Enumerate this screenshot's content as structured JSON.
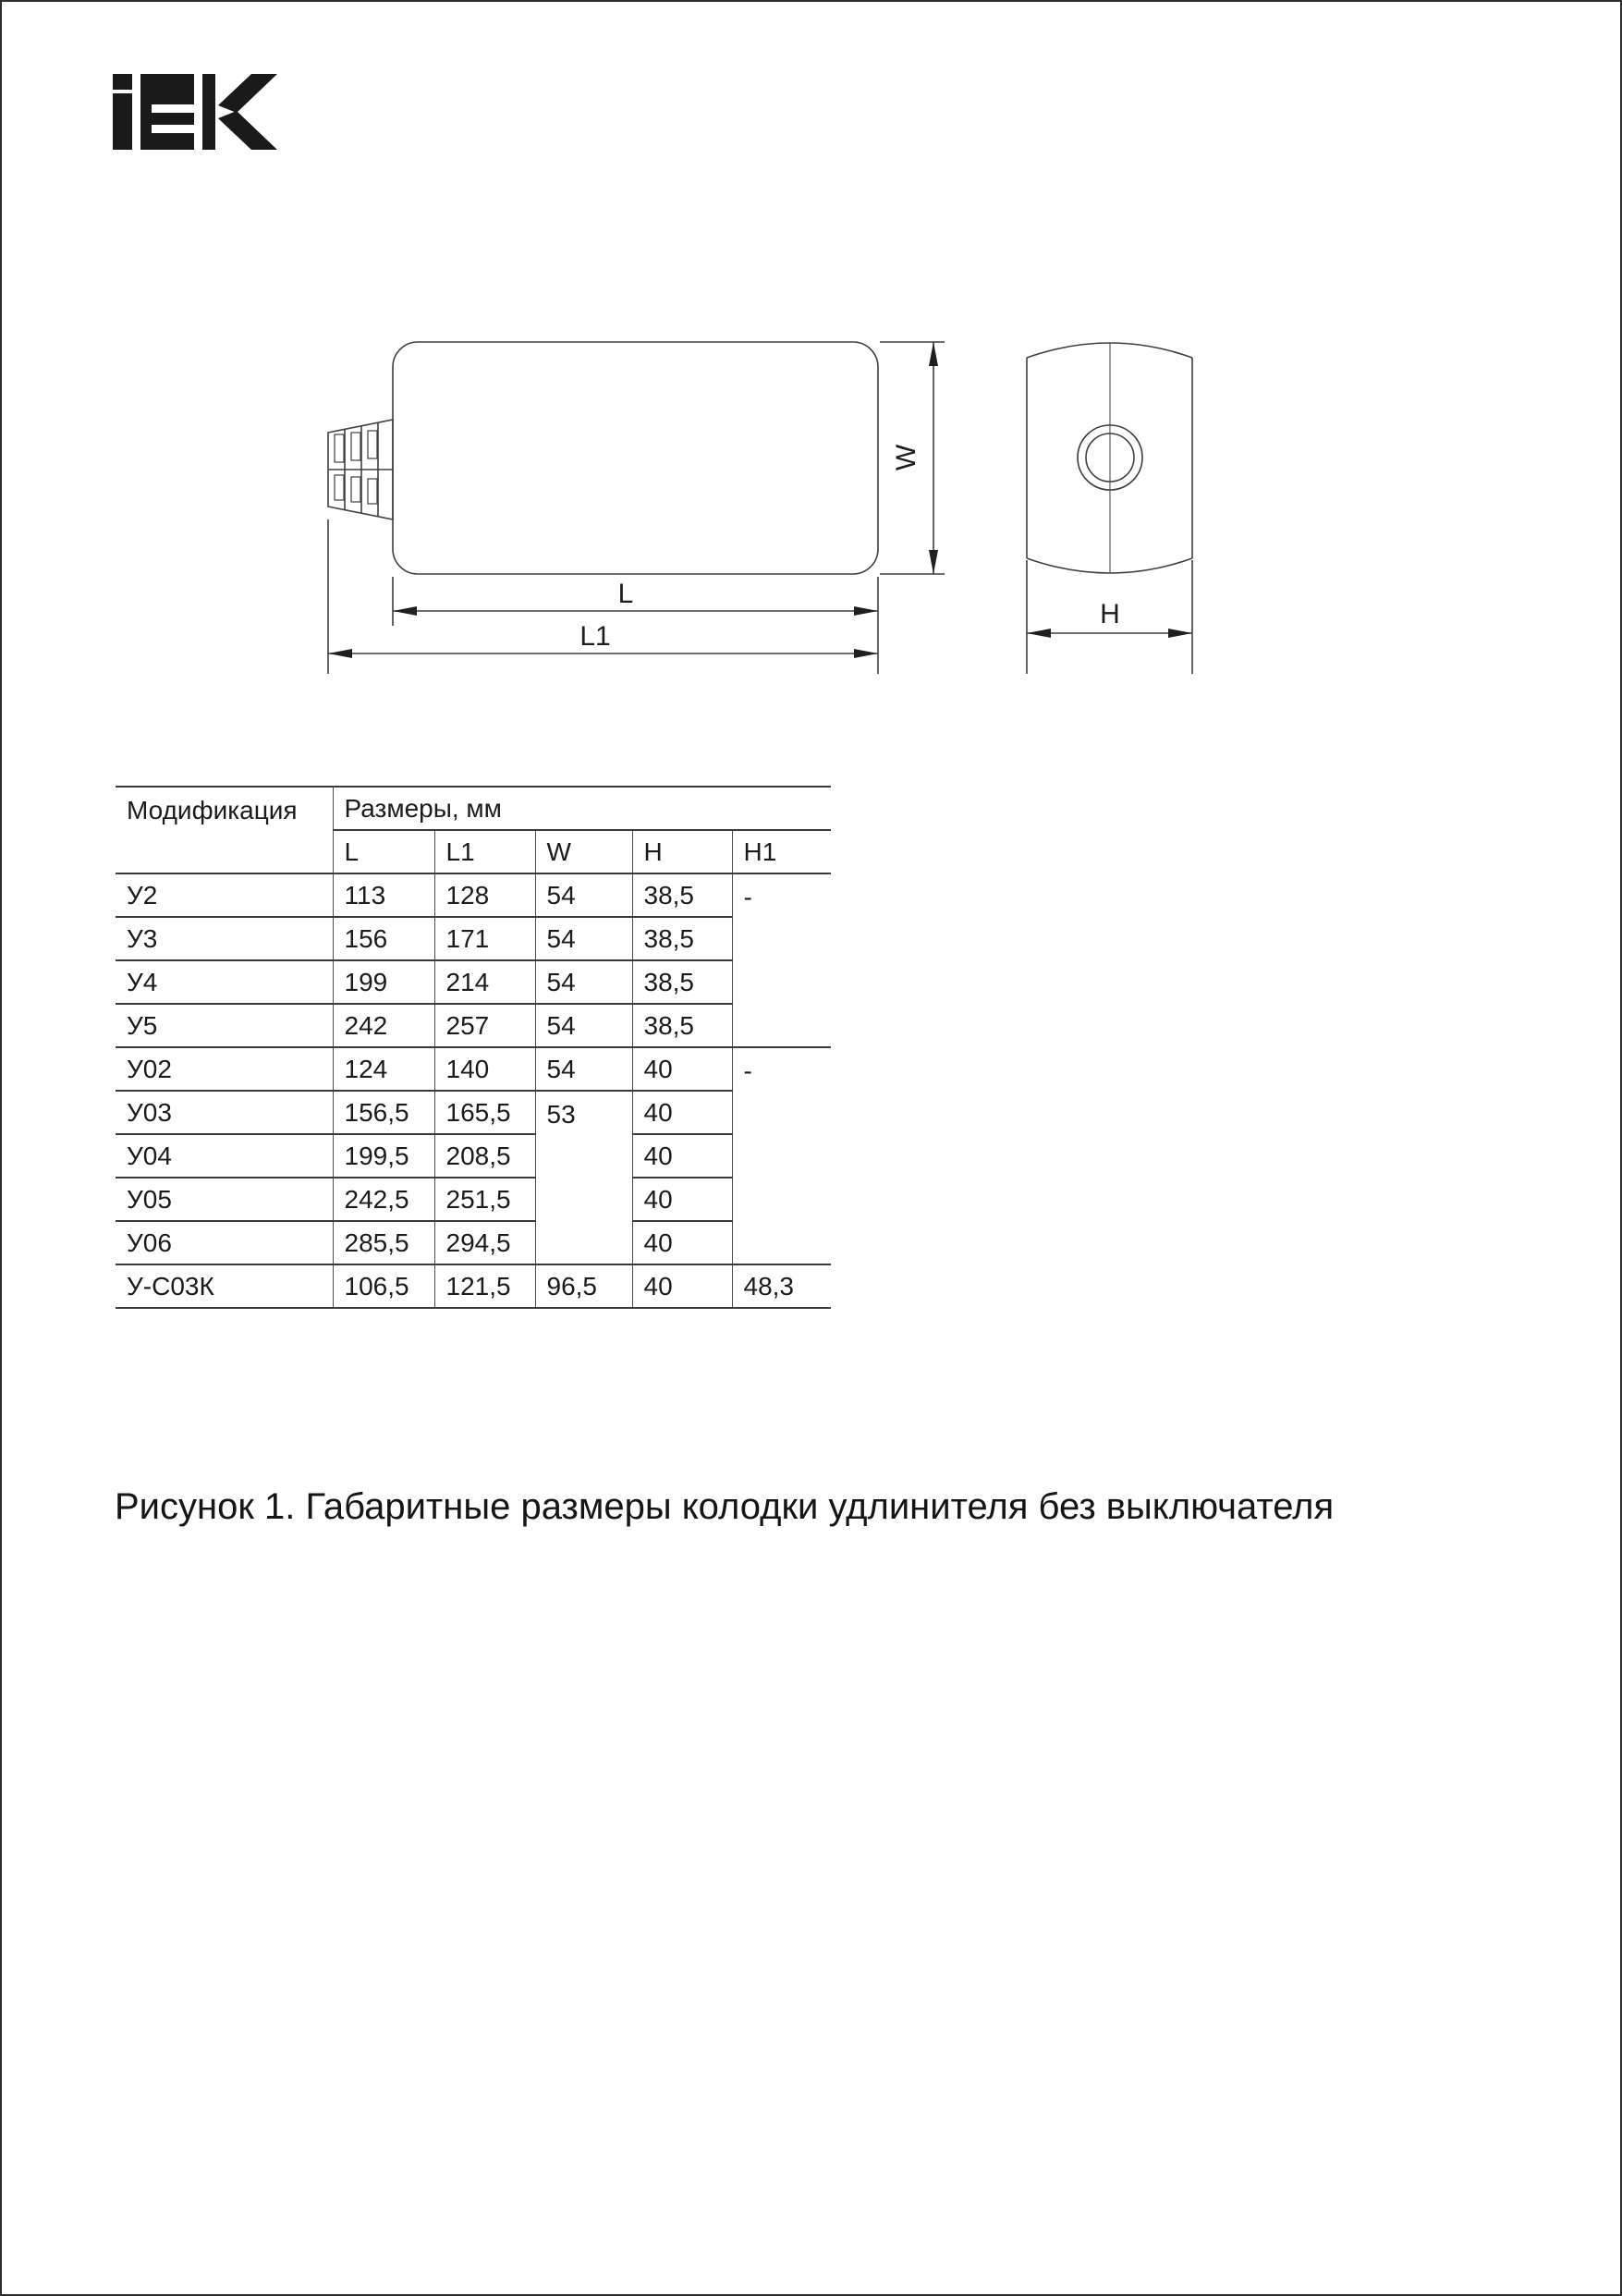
{
  "brand": {
    "name": "IEK"
  },
  "drawing": {
    "labels": {
      "length": "L",
      "length_full": "L1",
      "width": "W",
      "height": "H"
    }
  },
  "table": {
    "headers": {
      "modification": "Модификация",
      "dimensions_group": "Размеры, мм",
      "columns": [
        "L",
        "L1",
        "W",
        "H",
        "H1"
      ]
    },
    "rows": [
      {
        "name": "У2",
        "l": "113",
        "l1": "128",
        "w": "54",
        "h": "38,5",
        "h1": "-"
      },
      {
        "name": "У3",
        "l": "156",
        "l1": "171",
        "w": "54",
        "h": "38,5"
      },
      {
        "name": "У4",
        "l": "199",
        "l1": "214",
        "w": "54",
        "h": "38,5"
      },
      {
        "name": "У5",
        "l": "242",
        "l1": "257",
        "w": "54",
        "h": "38,5"
      },
      {
        "name": "У02",
        "l": "124",
        "l1": "140",
        "w": "54",
        "h": "40",
        "h1": "-"
      },
      {
        "name": "У03",
        "l": "156,5",
        "l1": "165,5",
        "w": "53",
        "h": "40"
      },
      {
        "name": "У04",
        "l": "199,5",
        "l1": "208,5",
        "h": "40"
      },
      {
        "name": "У05",
        "l": "242,5",
        "l1": "251,5",
        "h": "40"
      },
      {
        "name": "У06",
        "l": "285,5",
        "l1": "294,5",
        "h": "40"
      },
      {
        "name": "У-С03К",
        "l": "106,5",
        "l1": "121,5",
        "w": "96,5",
        "h": "40",
        "h1": "48,3"
      }
    ]
  },
  "caption": "Рисунок 1. Габаритные размеры колодки удлинителя без выключателя"
}
